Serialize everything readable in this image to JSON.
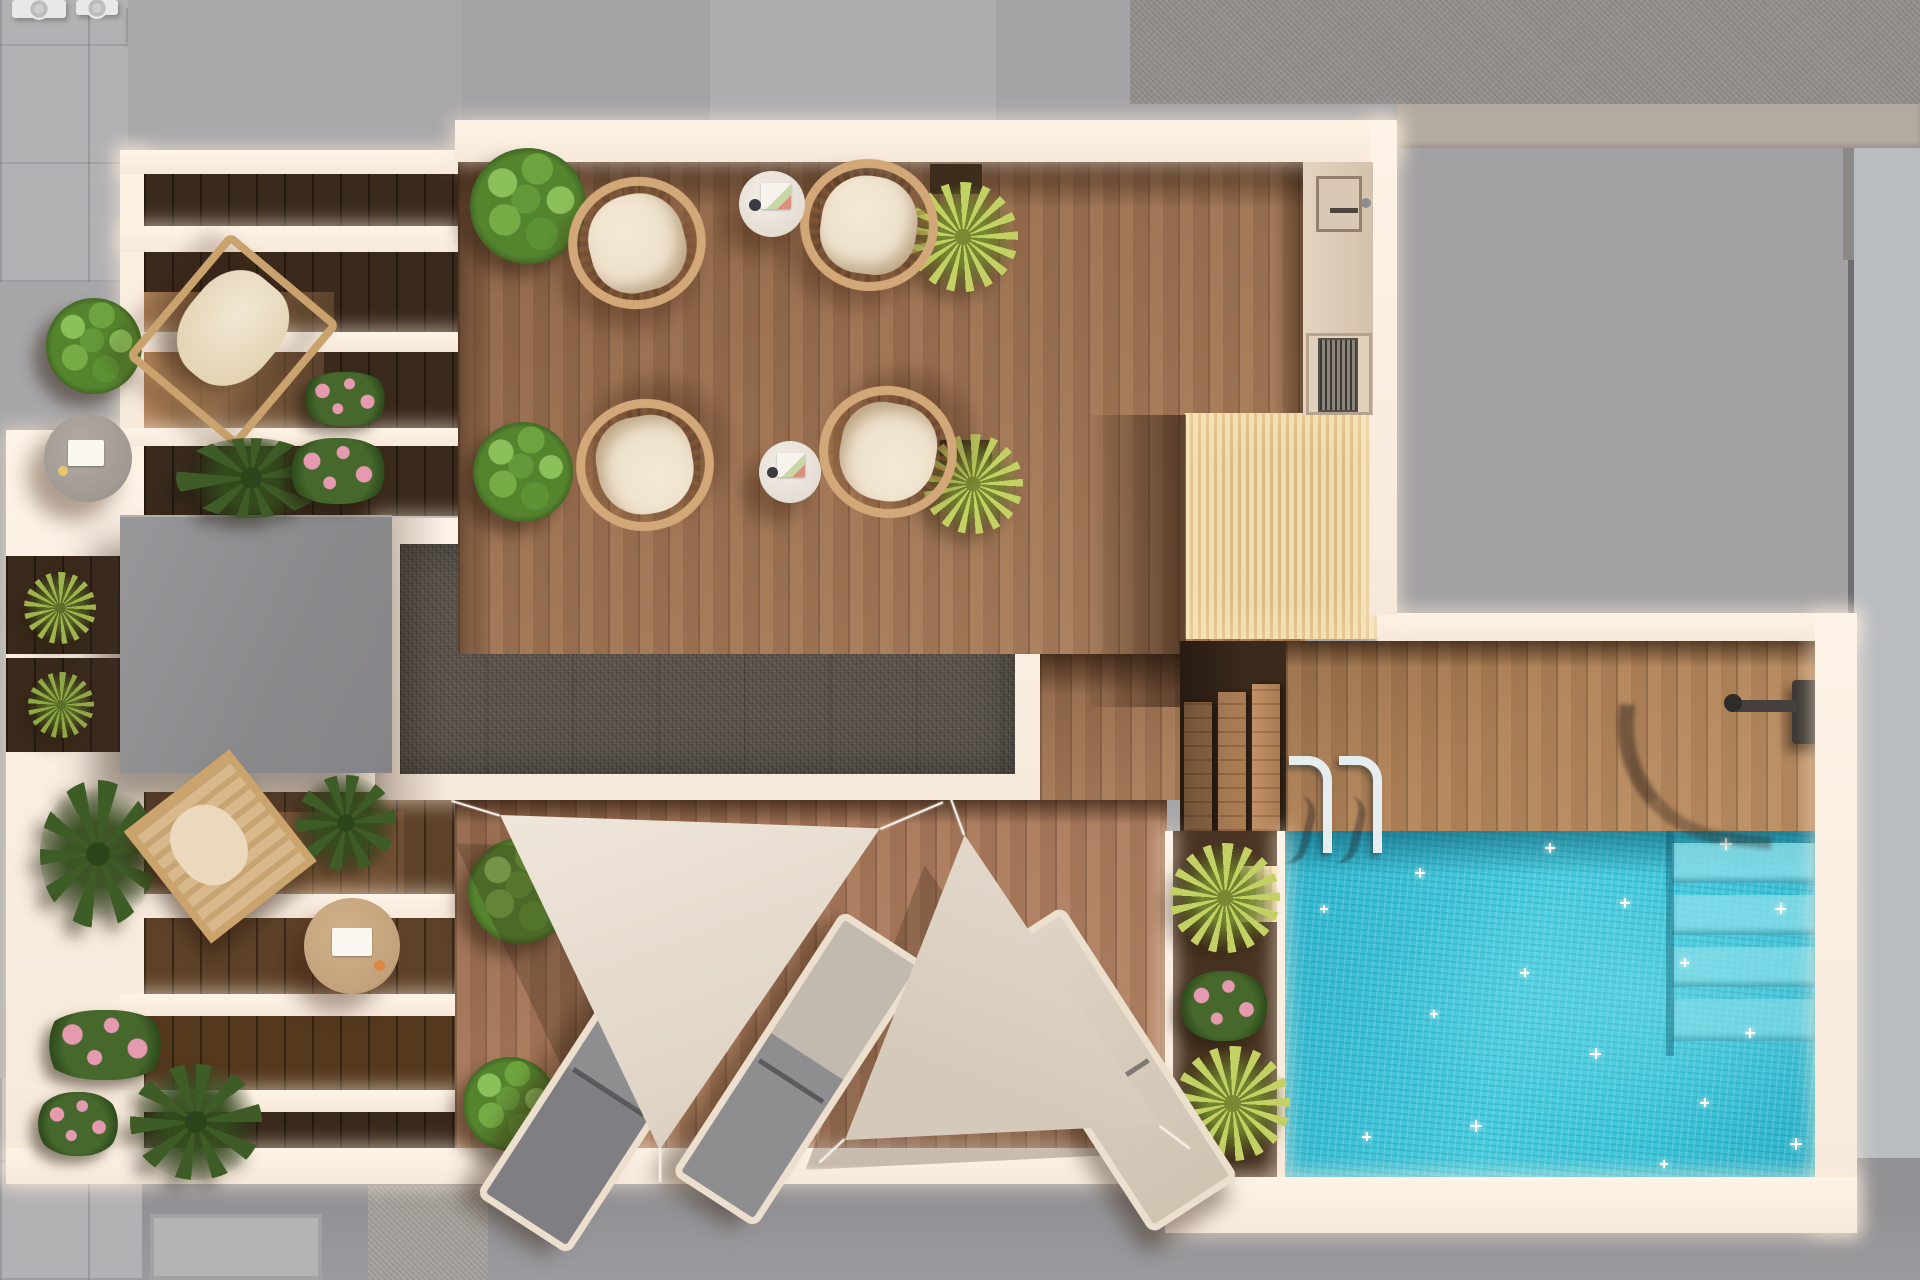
{
  "scene": {
    "type": "architectural-3d-render-top-view",
    "subject": "Rooftop terrace with swimming pool, wooden decks, dining set, pergola planters, shade sails and sun loungers",
    "areas": [
      {
        "id": "surroundings",
        "label": "Neighbouring gray rooftops and tiled pavement"
      },
      {
        "id": "pergola-wing",
        "label": "Pergola planter wing with white beams, plants, lounge chair, deck chair and side tables"
      },
      {
        "id": "dining-terrace",
        "label": "Wood dining terrace with four round wicker chairs and two white side tables"
      },
      {
        "id": "gravel-skylight",
        "label": "Gravel covered skylight with white frame"
      },
      {
        "id": "service-block",
        "label": "Gray roof access block"
      },
      {
        "id": "outdoor-kitchen",
        "label": "Outdoor kitchen counter with sink and grill"
      },
      {
        "id": "slat-deck",
        "label": "Light timber slatted deck"
      },
      {
        "id": "timber-steps",
        "label": "Timber steps down to the pool deck"
      },
      {
        "id": "pool-deck",
        "label": "Pool deck with outdoor shower and pool ladder"
      },
      {
        "id": "pool",
        "label": "Turquoise swimming pool with submerged corner steps and sun sparkles"
      },
      {
        "id": "shade-sail-area",
        "label": "Lounge deck with two triangular shade sails and three sun loungers"
      }
    ],
    "furniture_counts": {
      "wicker_chairs": 4,
      "white_side_tables": 2,
      "gray_side_table": 1,
      "tan_side_table": 1,
      "sun_loungers": 3,
      "lounge_chairs": 2,
      "shade_sails": 2,
      "bushes": 6,
      "yucca_plants": 5,
      "flower_planters": 4,
      "pool_ladder_handles": 2
    },
    "palette": {
      "surround": "#a7a6a9",
      "tile": "#b2b1b4",
      "speckle": "#93908d",
      "warmband": "#b3aaa2",
      "rightstrip": "#b9bdc2",
      "pavement": "#9b9a9e",
      "wall": "#f7e9da",
      "wallhi": "#fdf3e6",
      "wood": "#9b6f4f",
      "woodlight": "#b98a5e",
      "woodgap": "#3a2a1c",
      "wingwood": "#6b4c33",
      "pooldeckwood": "#b08257",
      "pocket": "#4a3423",
      "slat": "#f0dcae",
      "slatline": "#d8b883",
      "gravel": "#57504a",
      "elevator": "#8f8e91",
      "pool": "#3cc5d9",
      "pooldeep": "#23a8c2",
      "poolshadow": "#15798f",
      "poolstep": "#8ce0eb",
      "sail": "#e9dfd3",
      "sail2": "#dcd0c3",
      "cord": "#f5efe6",
      "bush": "#55842e",
      "bushlight": "#8cc05a",
      "yucca": "#c3d063",
      "leafy": "#3d5c26",
      "pink": "#e59ab0",
      "rattan": "#d3a878",
      "cushion": "#eee0ca",
      "loungergray": "#8a898c",
      "loungercream": "#d8cdbf"
    }
  }
}
